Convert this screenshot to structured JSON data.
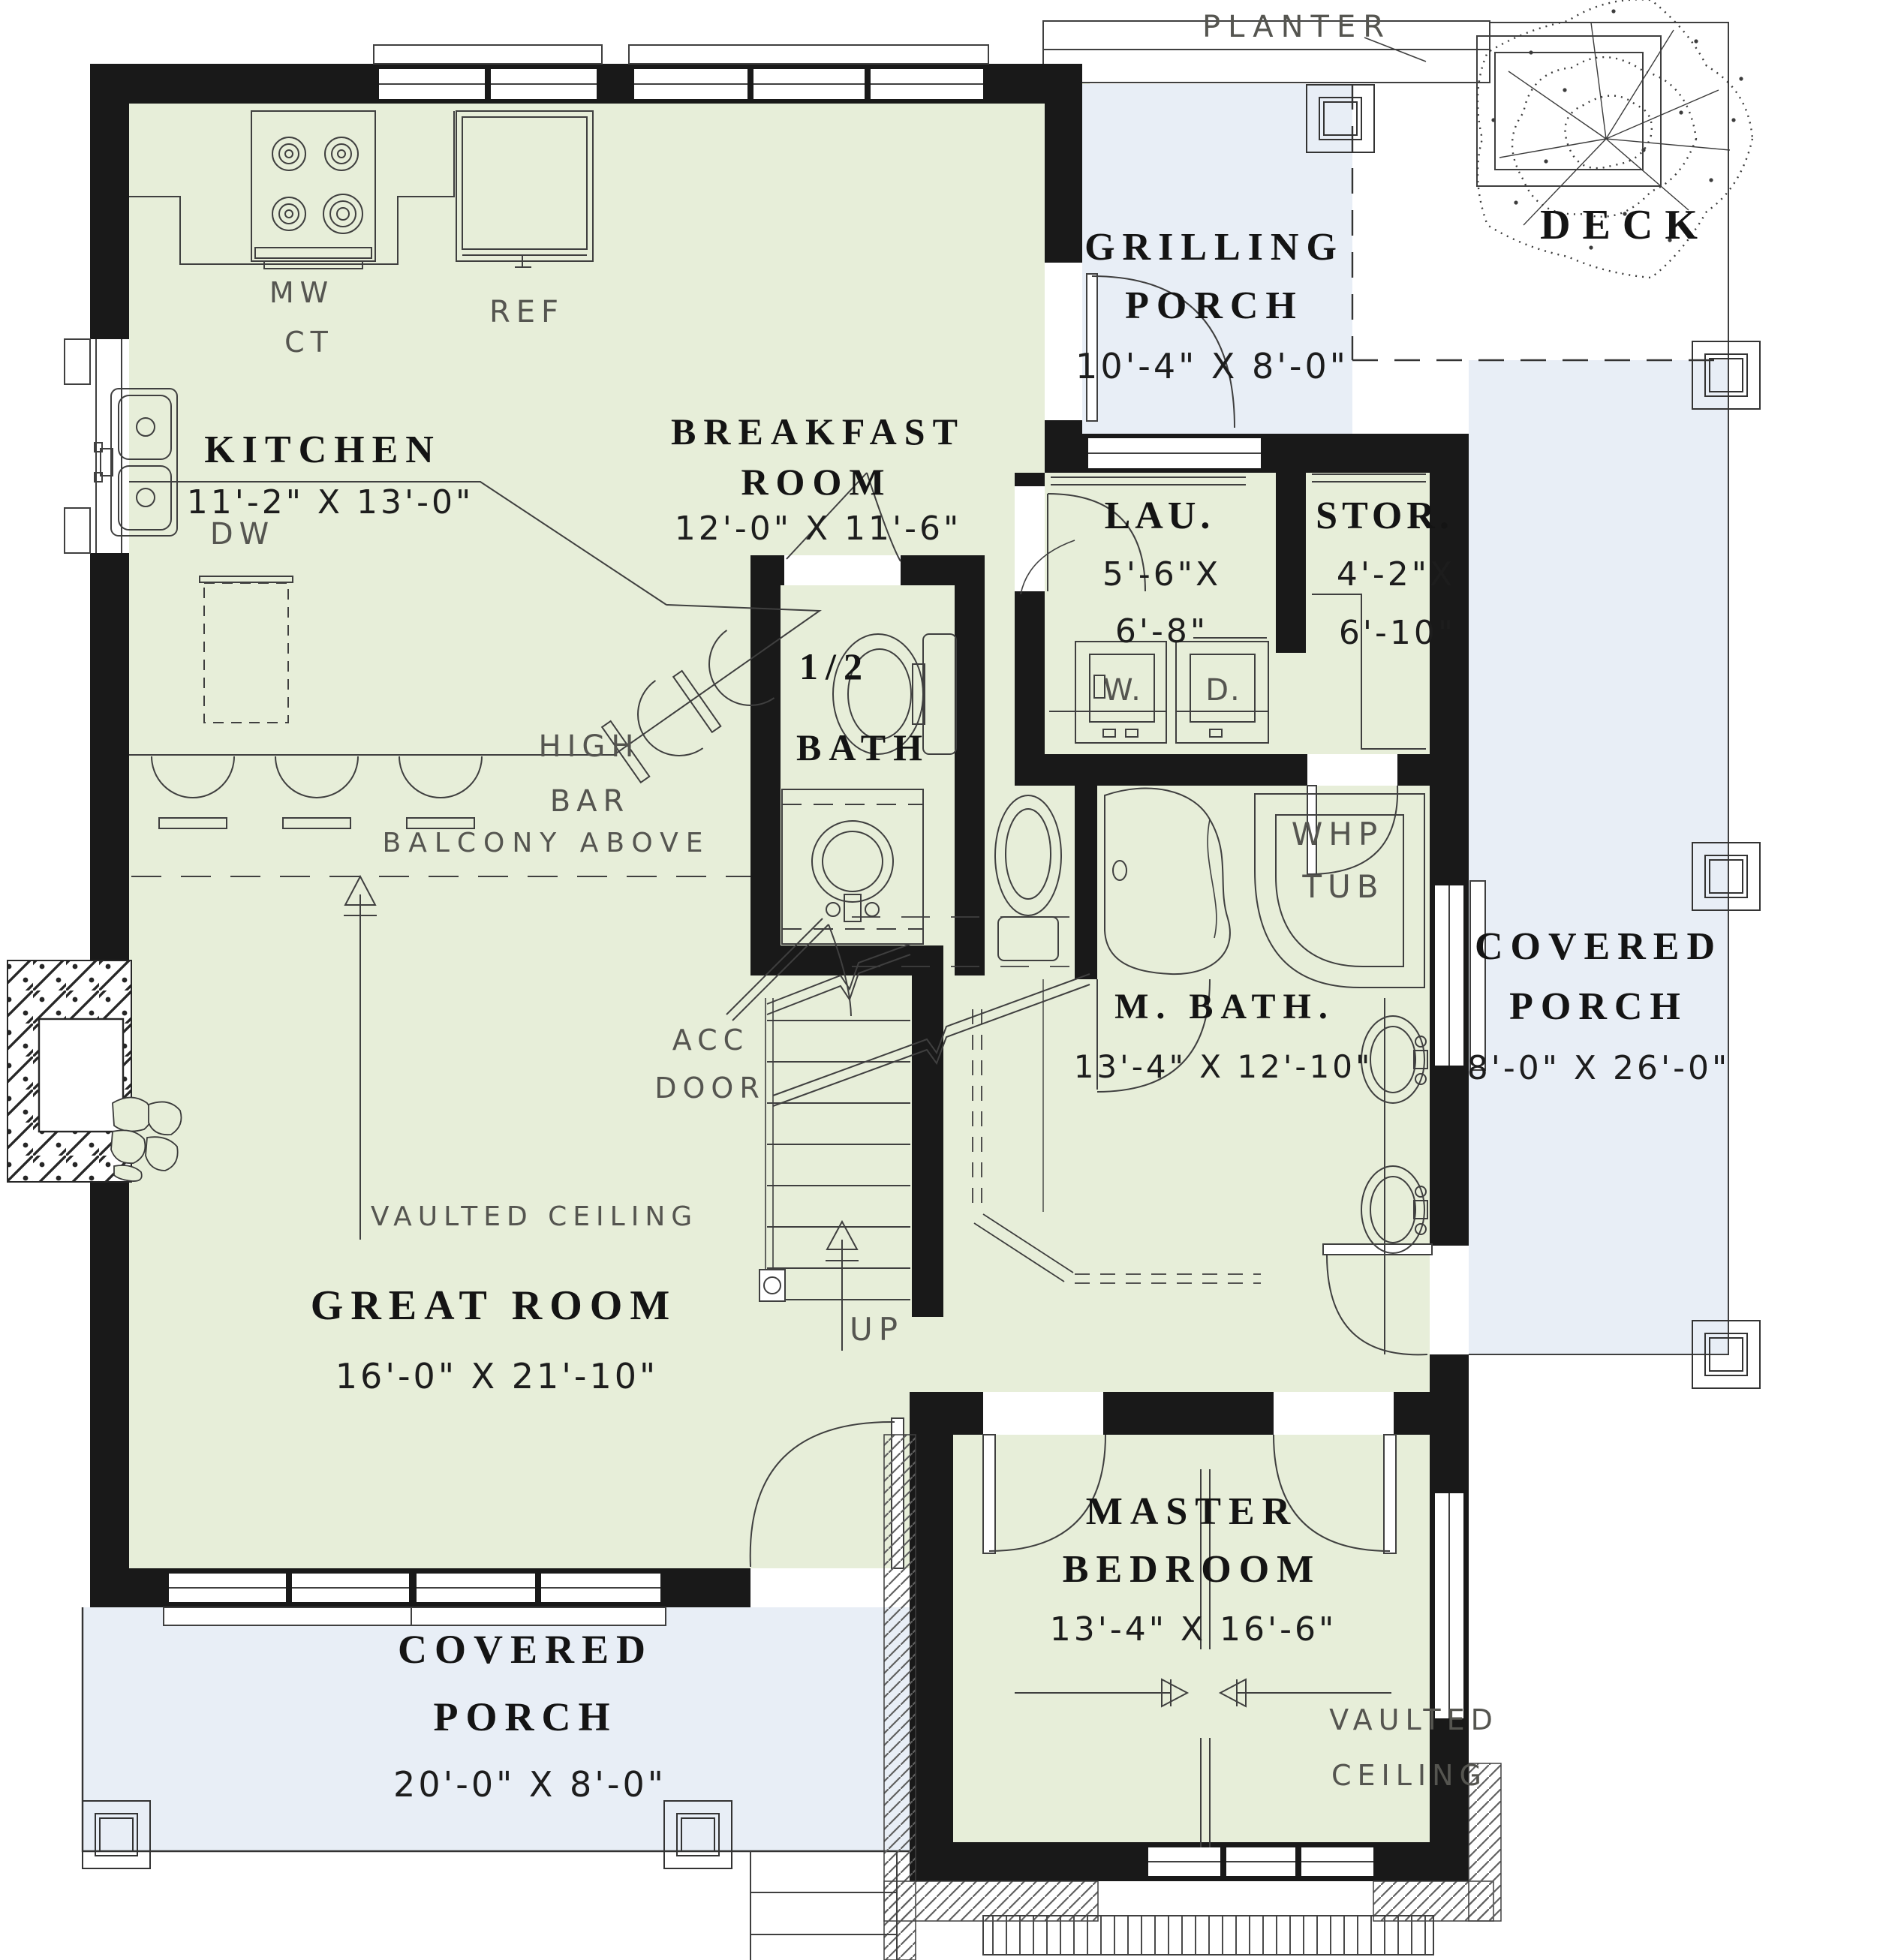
{
  "title": "First floor house plan",
  "colors": {
    "floor_green": "#e7eed9",
    "porch_blue": "#e8eef6",
    "wall_black": "#191919",
    "line_gray": "#3f3f3f",
    "label_gray": "#555550"
  },
  "rooms": {
    "kitchen": {
      "name": "KITCHEN",
      "dims": "11'-2\" X 13'-0\""
    },
    "breakfast": {
      "line1": "BREAKFAST",
      "line2": "ROOM",
      "dims": "12'-0\" X 11'-6\""
    },
    "grilling_porch": {
      "line1": "GRILLING",
      "line2": "PORCH",
      "dims": "10'-4\" X 8'-0\""
    },
    "deck": {
      "name": "DECK"
    },
    "laundry": {
      "name": "LAU.",
      "dim1": "5'-6\"X",
      "dim2": "6'-8\""
    },
    "storage": {
      "name": "STOR.",
      "dim1": "4'-2\"X",
      "dim2": "6'-10\""
    },
    "half_bath": {
      "line1": "1/2",
      "line2": "BATH"
    },
    "master_bath": {
      "name": "M. BATH.",
      "dims": "13'-4\" X 12'-10\""
    },
    "covered_porch_right": {
      "line1": "COVERED",
      "line2": "PORCH",
      "dims": "8'-0\" X 26'-0\""
    },
    "great_room": {
      "name": "GREAT ROOM",
      "dims": "16'-0\" X 21'-10\""
    },
    "master_bedroom": {
      "line1": "MASTER",
      "line2": "BEDROOM",
      "dims": "13'-4\" X 16'-6\""
    },
    "covered_porch_front": {
      "line1": "COVERED",
      "line2": "PORCH",
      "dims": "20'-0\" X 8'-0\""
    }
  },
  "annotations": {
    "planter": "PLANTER",
    "mw": "MW",
    "ct": "CT",
    "ref": "REF",
    "dw": "DW",
    "high": "HIGH",
    "bar": "BAR",
    "balcony_above": "BALCONY ABOVE",
    "acc": "ACC",
    "door": "DOOR",
    "vaulted_ceiling_great": "VAULTED CEILING",
    "up": "UP",
    "washer": "W.",
    "dryer": "D.",
    "whp1": "WHP",
    "whp2": "TUB",
    "vaulted_master1": "VAULTED",
    "vaulted_master2": "CEILING"
  }
}
